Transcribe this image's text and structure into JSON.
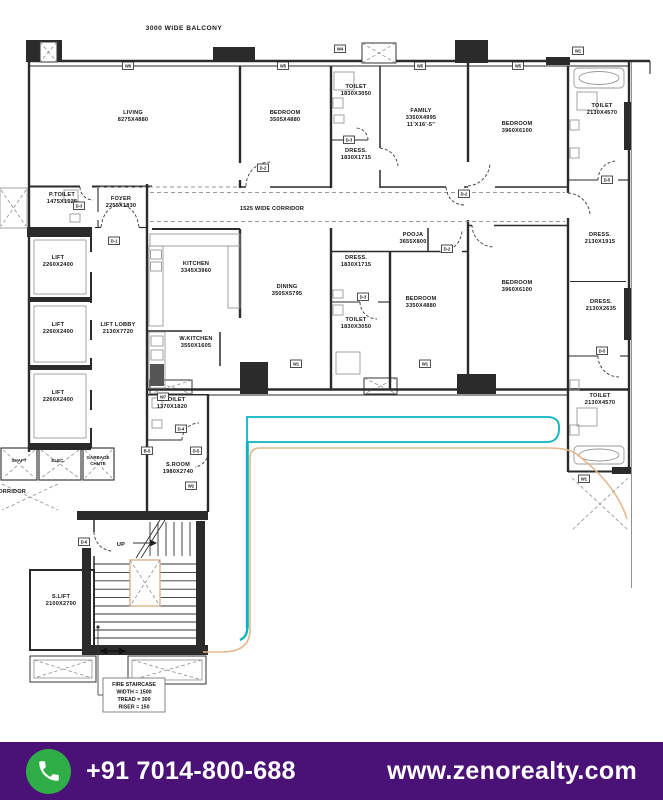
{
  "colors": {
    "wall": "#2b2b2b",
    "teal": "#0db4bd",
    "tan": "#e2b88d",
    "footer_bg": "#4a1276",
    "green": "#2fae48"
  },
  "footer": {
    "phone": "+91 7014-800-688",
    "website": "www.zenorealty.com"
  },
  "annotations": {
    "balcony": "3000 WIDE BALCONY",
    "corridor": "1525 WIDE CORRIDOR",
    "corridor_left": "CORRIDOR",
    "up": "UP",
    "fire_note_1": "FIRE STAIRCASE",
    "fire_note_2": "WIDTH = 1500",
    "fire_note_3": "TREAD = 300",
    "fire_note_4": "RISER = 150"
  },
  "rooms": {
    "living": {
      "name": "LIVING",
      "dim": "8275X4880"
    },
    "bedroom1": {
      "name": "BEDROOM",
      "dim": "3505X4880"
    },
    "toilet1": {
      "name": "TOILET",
      "dim": "1830X3050"
    },
    "dress1": {
      "name": "DRESS.",
      "dim": "1830X1715"
    },
    "family": {
      "name": "FAMILY",
      "dim": "3350X4995",
      "dim2": "11'X16'-5\""
    },
    "bedroom2": {
      "name": "BEDROOM",
      "dim": "3960X6100"
    },
    "toilet2": {
      "name": "TOILET",
      "dim": "2130X4570"
    },
    "ptoilet": {
      "name": "P.TOILET",
      "dim": "1475X1525"
    },
    "foyer": {
      "name": "FOYER",
      "dim": "2255X1830"
    },
    "lift1": {
      "name": "LIFT",
      "dim": "2260X2400"
    },
    "lift2": {
      "name": "LIFT",
      "dim": "2260X2400"
    },
    "lift3": {
      "name": "LIFT",
      "dim": "2260X2400"
    },
    "liftlobby": {
      "name": "LIFT LOBBY",
      "dim": "2130X7720"
    },
    "kitchen": {
      "name": "KITCHEN",
      "dim": "3345X3960"
    },
    "dining": {
      "name": "DINING",
      "dim": "3505X5795"
    },
    "wkitchen": {
      "name": "W.KITCHEN",
      "dim": "3550X1605"
    },
    "pooja": {
      "name": "POOJA",
      "dim": "3655X800"
    },
    "dress2": {
      "name": "DRESS.",
      "dim": "1830X1715"
    },
    "bedroom3": {
      "name": "BEDROOM",
      "dim": "3350X4880"
    },
    "bedroom4": {
      "name": "BEDROOM",
      "dim": "3960X6100"
    },
    "dress3": {
      "name": "DRESS.",
      "dim": "2130X1915"
    },
    "dress4": {
      "name": "DRESS.",
      "dim": "2130X2635"
    },
    "toilet3": {
      "name": "TOILET",
      "dim": "1830X3050"
    },
    "toilet4": {
      "name": "TOILET",
      "dim": "2130X4570"
    },
    "stoilet": {
      "name": "S.TOILET",
      "dim": "1370X1820"
    },
    "sroom": {
      "name": "S.ROOM",
      "dim": "1980X2740"
    },
    "slift": {
      "name": "S.LIFT",
      "dim": "2100X2700"
    },
    "elec": {
      "name": "ELEC."
    },
    "garbage": {
      "name": "GARBAGE",
      "name2": "CHUTE"
    },
    "shaft": {
      "name": "SHAFT"
    }
  },
  "markers": {
    "d1": "D-1",
    "d2": "D-2",
    "d3": "D-3",
    "d4": "D-4",
    "d5": "D-5",
    "d6": "D-6",
    "b5": "B-5",
    "w1": "W1",
    "w2": "W2",
    "w3": "W3",
    "w4": "W4",
    "w5": "W5",
    "w6": "W6",
    "w7": "W7"
  }
}
